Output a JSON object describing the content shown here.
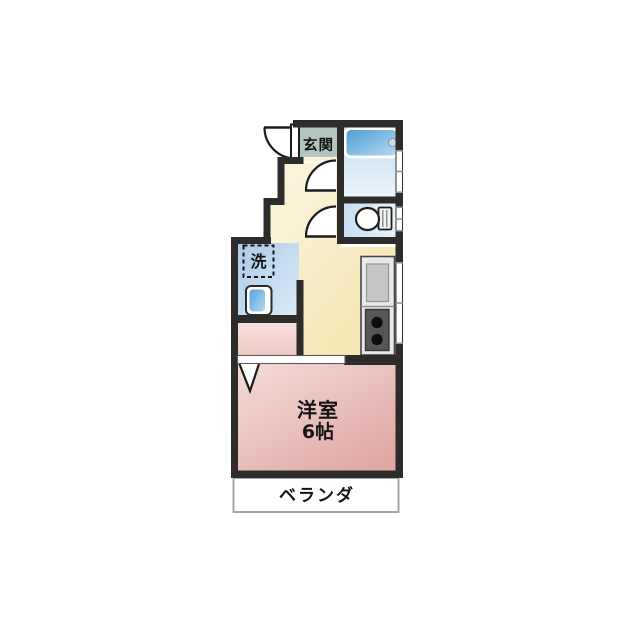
{
  "floorplan": {
    "labels": {
      "genkan": "玄関",
      "laundry": "洗",
      "room_name": "洋室",
      "room_size": "6帖",
      "veranda": "ベランダ"
    },
    "colors": {
      "wall": "#2e2c2a",
      "text": "#141414",
      "genkan_floor": "#b3c6bd",
      "hall_light": "#fcf7e8",
      "hall_dark": "#f5e3a8",
      "wet_dark": "#aac9e8",
      "wet_light": "#ddecf8",
      "bath_dark": "#bedaee",
      "bath_light": "#eef6fc",
      "toilet_dark": "#c6ddf1",
      "toilet_light": "#e9f3fb",
      "tub_dark": "#4a9bd3",
      "tub_light": "#b9dcf2",
      "washer_dark": "#57a3d8",
      "washer_light": "#b5d9f0",
      "room_light": "#f6deda",
      "room_dark": "#dfa8a3",
      "closet_light": "#f8e2de",
      "closet_dark": "#edc5c0",
      "kitchen_unit": "#e9e9e9",
      "kitchen_sink": "#c6c6c6",
      "stove": "#565656",
      "burner": "#0d0d0d",
      "veranda_border": "#a5a5a5"
    }
  }
}
